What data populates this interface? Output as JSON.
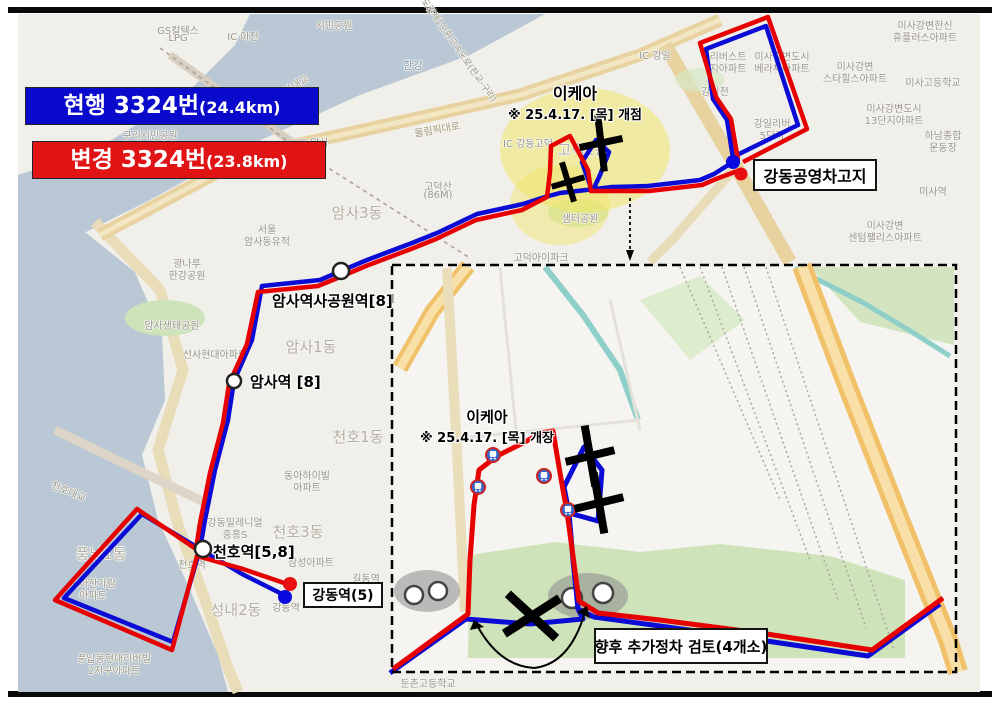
{
  "legend": {
    "current": {
      "label": "현행 3324번",
      "dist": "(24.4km)",
      "color": "#0a0acc"
    },
    "changed": {
      "label": "변경 3324번",
      "dist": "(23.8km)",
      "color": "#e01414"
    }
  },
  "callouts": {
    "ikea_main": {
      "title": "이케아",
      "subtitle": "※ 25.4.17. [목] 개점"
    },
    "ikea_inset": {
      "title": "이케아",
      "subtitle": "※ 25.4.17. [목] 개장"
    },
    "depot": "강동공영차고지",
    "gangdong_terminal": "강동역(5)",
    "future_stops": "향후 추가정차 검토(4개소)",
    "station_amsa_park": "암사역사공원역[8]",
    "station_amsa": "암사역 [8]",
    "station_cheonho": "천호역[5,8]"
  },
  "inset_roads": {
    "dongnam": "동남로",
    "godeok_bizvalley": "고덕비즈밸리로"
  },
  "colors": {
    "route_current": "#0b0bd6",
    "route_changed": "#e60000",
    "water": "#b9c8d4",
    "highlight": "#f1e567",
    "land": "#f1efe9"
  },
  "map_labels": [
    {
      "text": "GS칼텍스",
      "x": 178,
      "y": 22
    },
    {
      "text": "LPG",
      "x": 178,
      "y": 33
    },
    {
      "text": "IC 아천",
      "x": 243,
      "y": 28
    },
    {
      "text": "시민공원",
      "x": 334,
      "y": 17
    },
    {
      "text": "구리시민공원",
      "x": 150,
      "y": 127
    },
    {
      "text": "구리암사대교",
      "x": 284,
      "y": 84,
      "rot": -33
    },
    {
      "text": "한강",
      "x": 413,
      "y": 57,
      "c": "#7f95a9",
      "fs": 11
    },
    {
      "text": "수도권제1순환고속도로(판교-구리)",
      "x": 457,
      "y": 40,
      "rot": 55,
      "fs": 9
    },
    {
      "text": "IC 강일",
      "x": 655,
      "y": 47
    },
    {
      "text": "올림픽대로",
      "x": 437,
      "y": 121,
      "rot": -10,
      "c": "#a49a7e"
    },
    {
      "text": "IC 암사",
      "x": 313,
      "y": 134
    },
    {
      "text": "IC 강동고덕",
      "x": 528,
      "y": 135
    },
    {
      "text": "고덕산",
      "x": 438,
      "y": 178
    },
    {
      "text": "(86M)",
      "x": 438,
      "y": 190
    },
    {
      "text": "암사3동",
      "x": 357,
      "y": 202,
      "fs": 15,
      "c": "#b3b0a5"
    },
    {
      "text": "서울",
      "x": 267,
      "y": 221
    },
    {
      "text": "암사동유적",
      "x": 267,
      "y": 233
    },
    {
      "text": "광나루",
      "x": 187,
      "y": 255
    },
    {
      "text": "한강공원",
      "x": 187,
      "y": 267
    },
    {
      "text": "암사생태공원",
      "x": 172,
      "y": 317
    },
    {
      "text": "선사현대아파트",
      "x": 215,
      "y": 346
    },
    {
      "text": "암사1동",
      "x": 311,
      "y": 336,
      "fs": 15,
      "c": "#b3b0a5"
    },
    {
      "text": "고덕2동",
      "x": 583,
      "y": 139,
      "fs": 15,
      "c": "#b3b0a5"
    },
    {
      "text": "샘터공원",
      "x": 580,
      "y": 210
    },
    {
      "text": "고덕아이파크",
      "x": 541,
      "y": 249
    },
    {
      "text": "리버스트",
      "x": 728,
      "y": 48
    },
    {
      "text": "지아파트",
      "x": 728,
      "y": 60
    },
    {
      "text": "미사강변한신",
      "x": 925,
      "y": 17
    },
    {
      "text": "휴플러스아파트",
      "x": 925,
      "y": 29
    },
    {
      "text": "미사강변도시",
      "x": 782,
      "y": 48
    },
    {
      "text": "베라체아파트",
      "x": 782,
      "y": 60
    },
    {
      "text": "미사강변",
      "x": 855,
      "y": 58
    },
    {
      "text": "스타힐스아파트",
      "x": 855,
      "y": 70
    },
    {
      "text": "미사고등학교",
      "x": 933,
      "y": 74
    },
    {
      "text": "미사강변도시",
      "x": 894,
      "y": 100
    },
    {
      "text": "13단지아파트",
      "x": 894,
      "y": 112
    },
    {
      "text": "하남종합",
      "x": 943,
      "y": 127
    },
    {
      "text": "운동장",
      "x": 943,
      "y": 139
    },
    {
      "text": "강일리버",
      "x": 772,
      "y": 115
    },
    {
      "text": "5단지",
      "x": 772,
      "y": 127
    },
    {
      "text": "강월천",
      "x": 715,
      "y": 83
    },
    {
      "text": "미사역",
      "x": 933,
      "y": 183
    },
    {
      "text": "미사강변",
      "x": 885,
      "y": 217
    },
    {
      "text": "센텀팰리스아파트",
      "x": 885,
      "y": 229
    },
    {
      "text": "천호1동",
      "x": 358,
      "y": 426,
      "fs": 15,
      "c": "#b3b0a5"
    },
    {
      "text": "동아하이빌",
      "x": 307,
      "y": 467
    },
    {
      "text": "아파트",
      "x": 307,
      "y": 479
    },
    {
      "text": "천호대교",
      "x": 69,
      "y": 483,
      "rot": 22
    },
    {
      "text": "풍납1동",
      "x": 101,
      "y": 543,
      "fs": 15,
      "c": "#b3b0a5"
    },
    {
      "text": "동아한가람",
      "x": 93,
      "y": 575
    },
    {
      "text": "아파트",
      "x": 93,
      "y": 587
    },
    {
      "text": "강동밀레니얼",
      "x": 235,
      "y": 514
    },
    {
      "text": "중흥S",
      "x": 235,
      "y": 526
    },
    {
      "text": "천호3동",
      "x": 298,
      "y": 521,
      "fs": 15,
      "c": "#b3b0a5"
    },
    {
      "text": "삼성아파트",
      "x": 311,
      "y": 554
    },
    {
      "text": "길동역",
      "x": 366,
      "y": 570
    },
    {
      "text": "천호역",
      "x": 192,
      "y": 556
    },
    {
      "text": "강동역",
      "x": 286,
      "y": 599
    },
    {
      "text": "성내2동",
      "x": 236,
      "y": 599,
      "fs": 15,
      "c": "#b3b0a5"
    },
    {
      "text": "풍납동현대리버빌",
      "x": 114,
      "y": 650
    },
    {
      "text": "2지구아파트",
      "x": 114,
      "y": 662
    },
    {
      "text": "둔촌고등학교",
      "x": 428,
      "y": 675
    }
  ]
}
